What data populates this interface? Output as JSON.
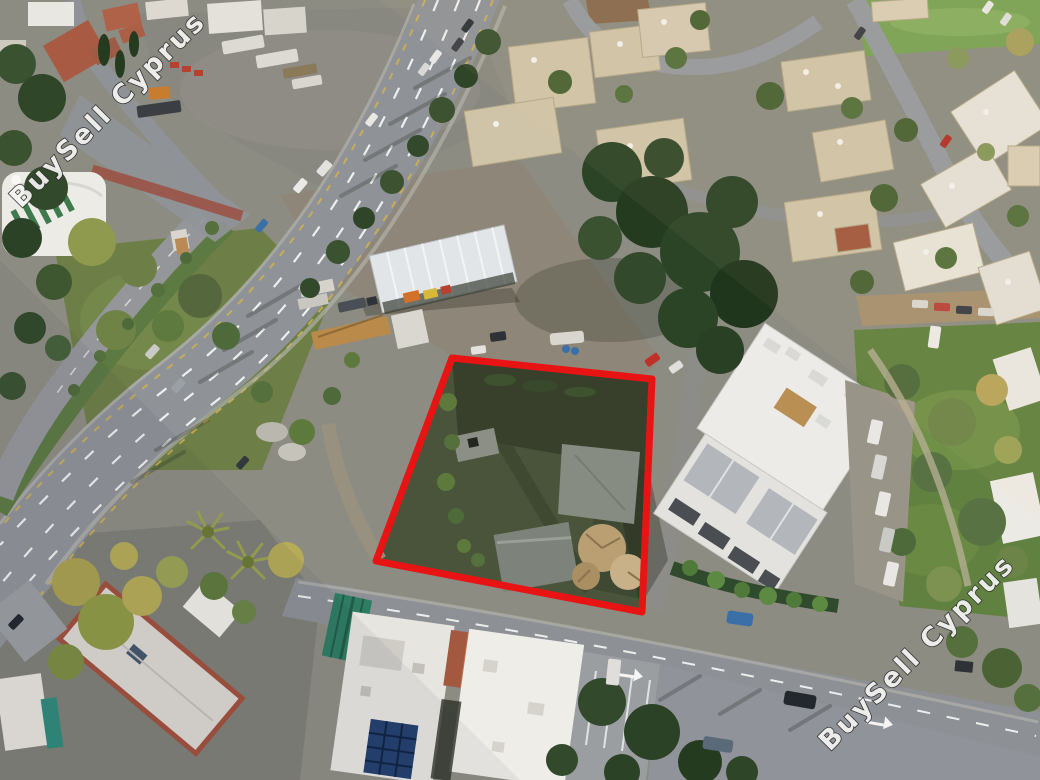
{
  "meta": {
    "type": "aerial-drone-photograph",
    "subject": "Vacant building plot outlined in red in an urban Cyprus neighbourhood (real-estate listing photo)",
    "lighting": "low late-afternoon sun, long shadows cast toward the lower left"
  },
  "watermark": {
    "text": "BuySell Cyprus",
    "fill": "#f4f4f2",
    "outline": "#2c2c2c",
    "rotation_deg": -45,
    "instances": [
      {
        "position": "top-left",
        "x": 114,
        "y": 116
      },
      {
        "position": "bottom-right",
        "x": 923,
        "y": 659
      }
    ]
  },
  "plot_outline": {
    "color": "#e81414",
    "stroke_width": 7,
    "shape": "quadrilateral",
    "points": "452,358 652,379 642,612 376,561"
  },
  "scene": {
    "palette": {
      "asphalt": "#8f9296",
      "gravel": "#888780",
      "dirt": "#8e8678",
      "dirt_road": "#a5906f",
      "grass": "#6d7f46",
      "lawn": "#60813f",
      "scrub_dark": "#55663c",
      "plot_ground": "#49543a",
      "building_white": "#ecebe7",
      "building_beige": "#cfc3a8",
      "roof_terracotta": "#a2593f",
      "roof_gray_shingle": "#b3b7bb",
      "shed_green": "#2e7d62",
      "solar_panel": "#24406e",
      "lane_marking": "#ffffff",
      "edge_marking": "#d4b44c",
      "bike_path": "#9c4f42"
    },
    "landmarks": [
      "dual-carriageway avenue crossing diagonally with dashed lane markings",
      "service road and planted median with small kiosk",
      "storage yard with truck trailers, containers and machinery",
      "open-sided warehouse with white corrugated roof",
      "vacant plot outlined in red containing concrete slabs, scrub and a bare tree",
      "modern white apartment complex with balconies and parking row",
      "rows of beige flat-roofed apartment blocks with rooftop solar water heaters",
      "white flat-roofed houses along the bottom street",
      "rooftop solar-panel array",
      "green pitched-roof shed",
      "palm trees beside the avenue",
      "red-brown cycle path at the road junction",
      "plowed field and green field strips at the top edge"
    ],
    "vehicles": {
      "cars_on_avenue": 9,
      "trucks_and_trailers_in_yard": 8,
      "cars_parked_near_apartments": 9,
      "cars_bottom_roads": 6
    }
  }
}
